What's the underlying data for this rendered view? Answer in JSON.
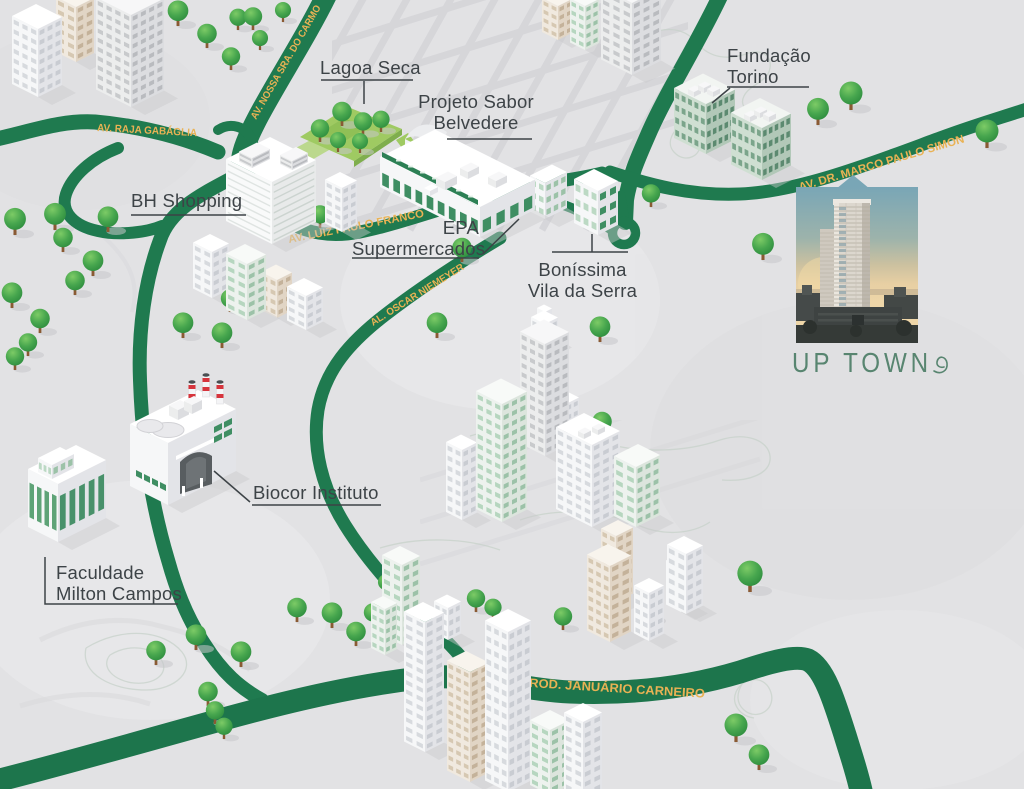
{
  "map": {
    "type": "illustrated-neighborhood-map",
    "city_area": "Belvedere / Vila da Serra"
  },
  "roads": {
    "raja": "AV. RAJA GABÁGLIA",
    "nossa": "AV. NOSSA SRA. DO CARMO",
    "franco": "AV. LUIZ PAULO FRANCO",
    "oscar": "AL. OSCAR NIEMEYER",
    "marco": "AV. DR. MARCO PAULO SIMON",
    "januario": "ROD. JANUÁRIO CARNEIRO"
  },
  "pois": {
    "lagoa_seca": {
      "name": "Lagoa Seca"
    },
    "projeto_sabor": {
      "line1": "Projeto Sabor",
      "line2": "Belvedere"
    },
    "fundacao_torino": {
      "line1": "Fundação",
      "line2": "Torino"
    },
    "bh_shopping": {
      "name": "BH Shopping"
    },
    "epa": {
      "line1": "EPA",
      "line2": "Supermercados"
    },
    "bonissima": {
      "line1": "Boníssima",
      "line2": "Vila da Serra"
    },
    "biocor": {
      "name": "Biocor Instituto"
    },
    "faculdade": {
      "line1": "Faculdade",
      "line2": "Milton Campos"
    }
  },
  "logo": {
    "text": "UP TOWN"
  },
  "colors": {
    "road_green": "#1f7a4f",
    "road_label_gold": "#e9b254",
    "label_text": "#3d4347",
    "logo_green": "#588570",
    "tree_green": "#3ea24b",
    "park_green": "#9fca62",
    "background": "#e2e2e4"
  }
}
